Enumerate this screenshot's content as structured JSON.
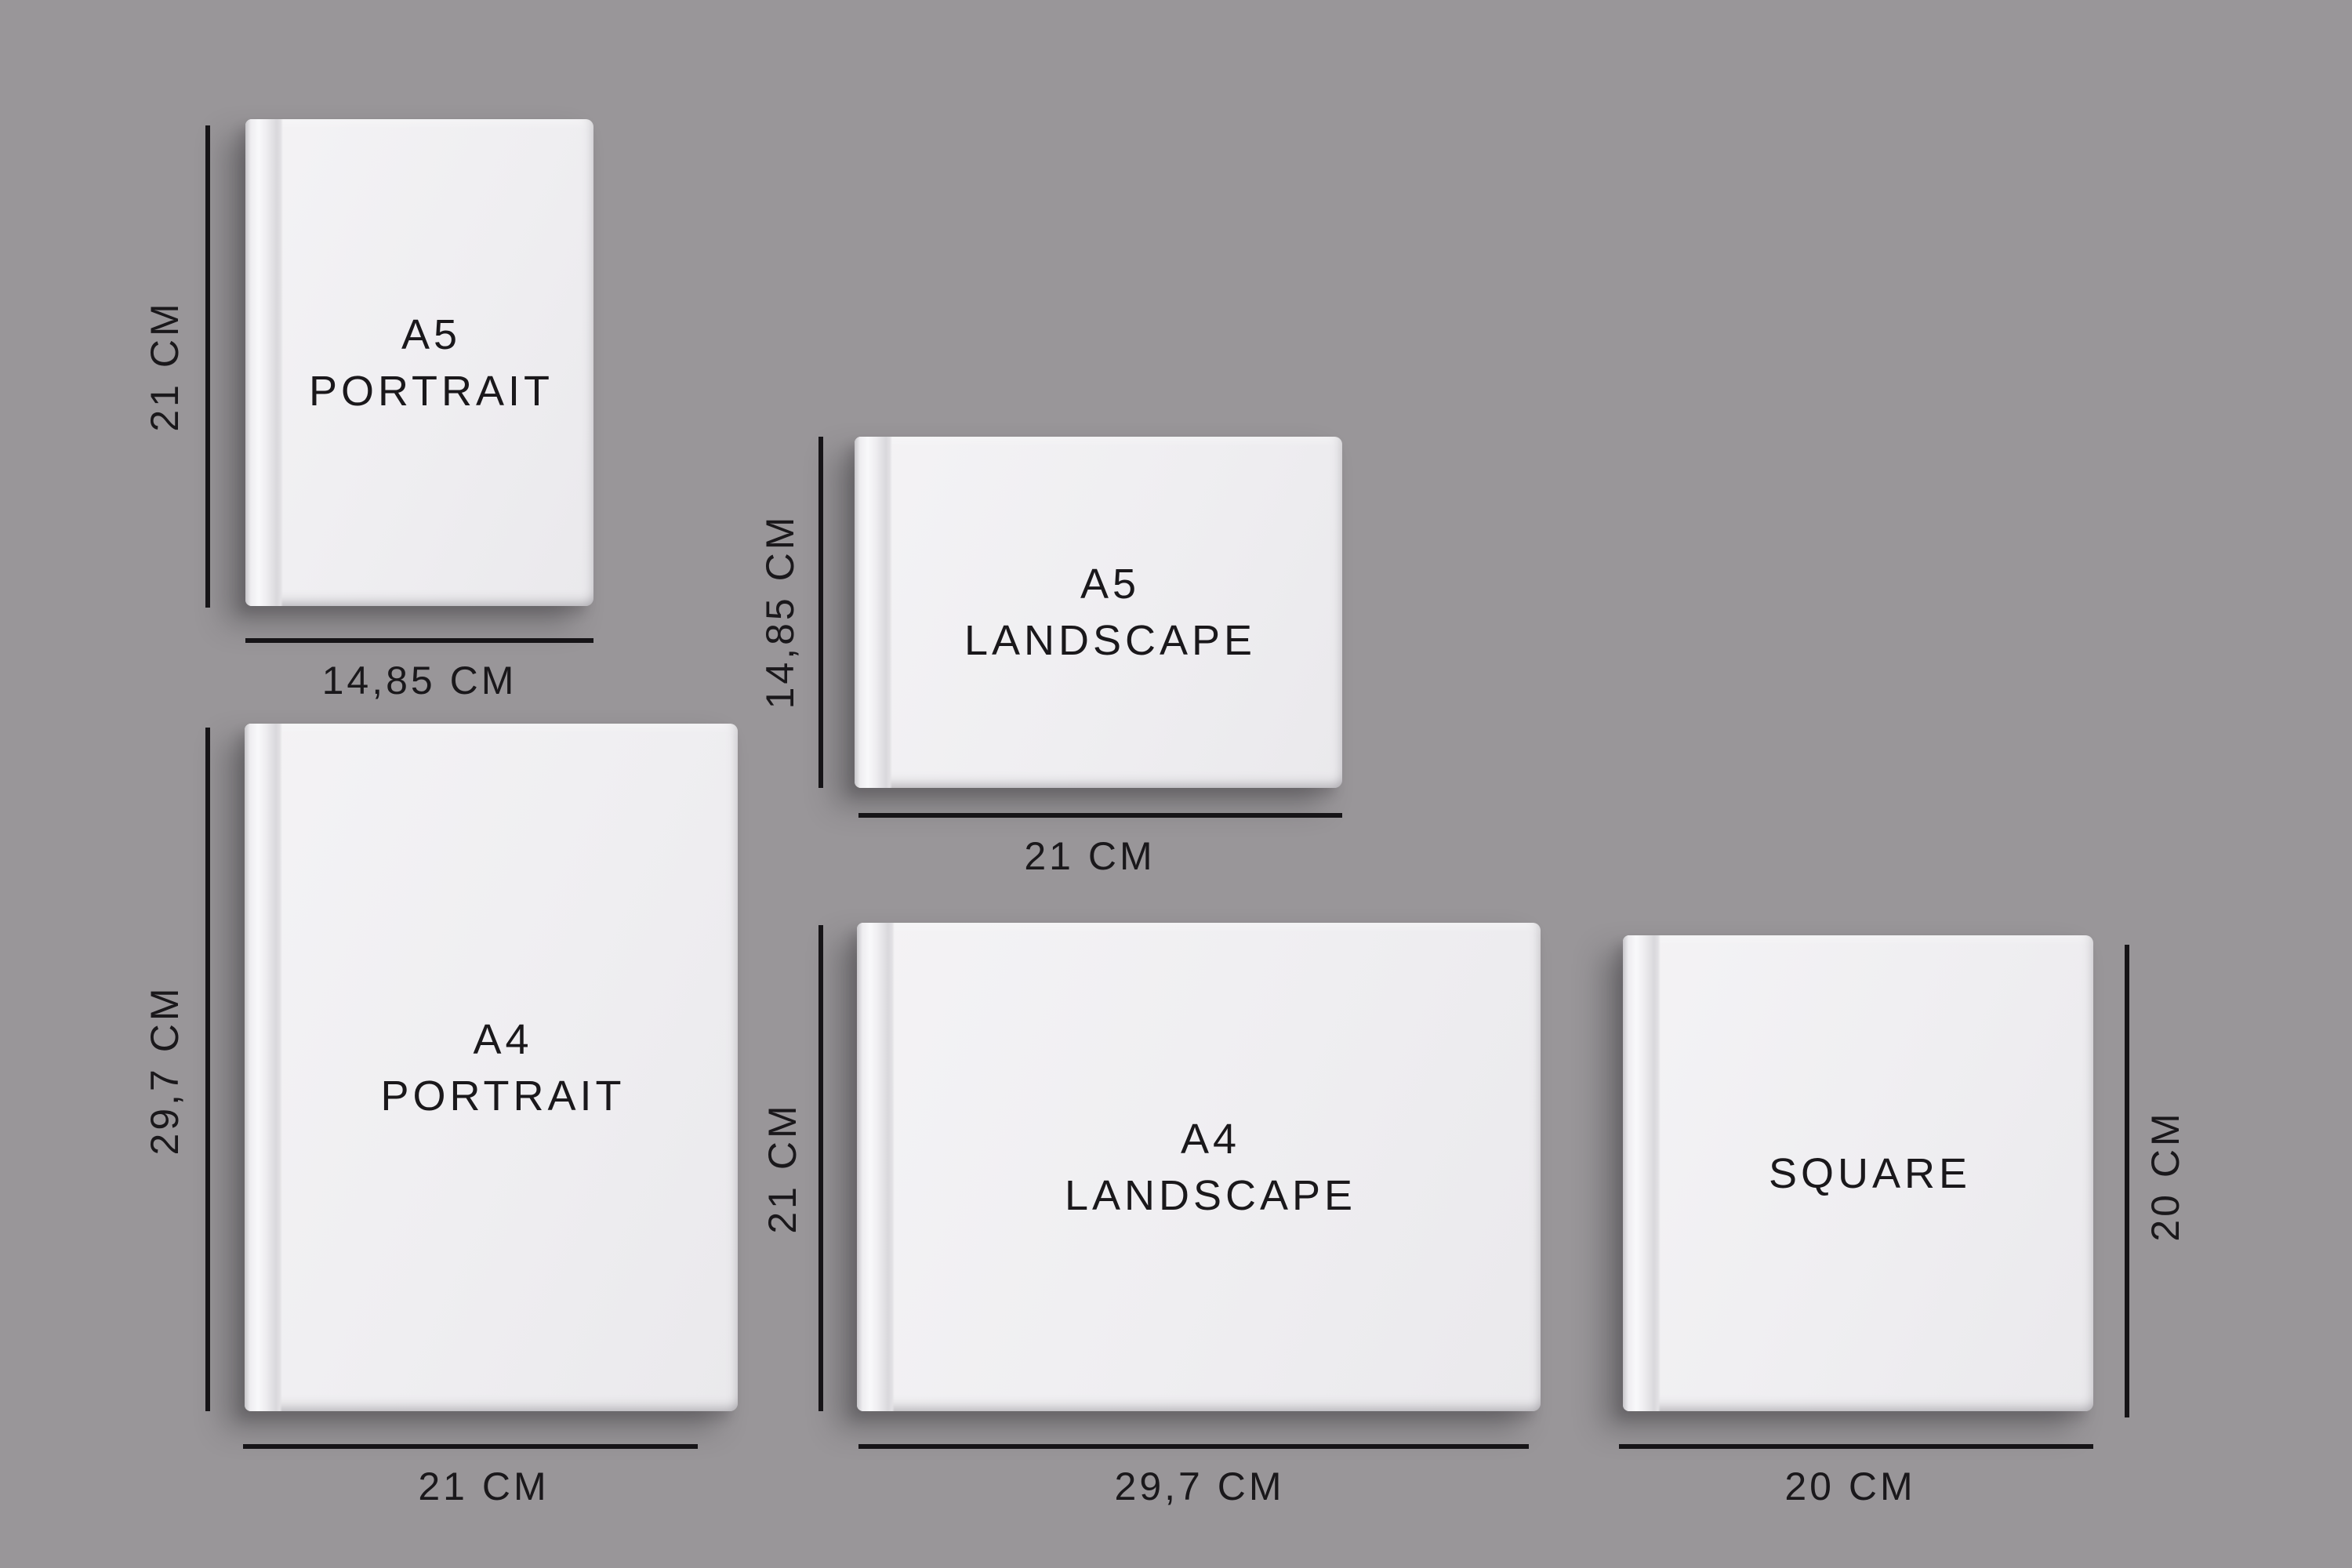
{
  "colors": {
    "background": "#999699",
    "book_cover": "#f1f0f2",
    "ink": "#1a181b"
  },
  "books": {
    "a5_portrait": {
      "name_line1": "A5",
      "name_line2": "PORTRAIT",
      "height_label": "21 CM",
      "width_label": "14,85 CM"
    },
    "a5_landscape": {
      "name_line1": "A5",
      "name_line2": "LANDSCAPE",
      "height_label": "14,85 CM",
      "width_label": "21 CM"
    },
    "a4_portrait": {
      "name_line1": "A4",
      "name_line2": "PORTRAIT",
      "height_label": "29,7 CM",
      "width_label": "21 CM"
    },
    "a4_landscape": {
      "name_line1": "A4",
      "name_line2": "LANDSCAPE",
      "height_label": "21 CM",
      "width_label": "29,7 CM"
    },
    "square": {
      "name_line1": "SQUARE",
      "name_line2": "",
      "height_label": "20 CM",
      "width_label": "20 CM"
    }
  }
}
